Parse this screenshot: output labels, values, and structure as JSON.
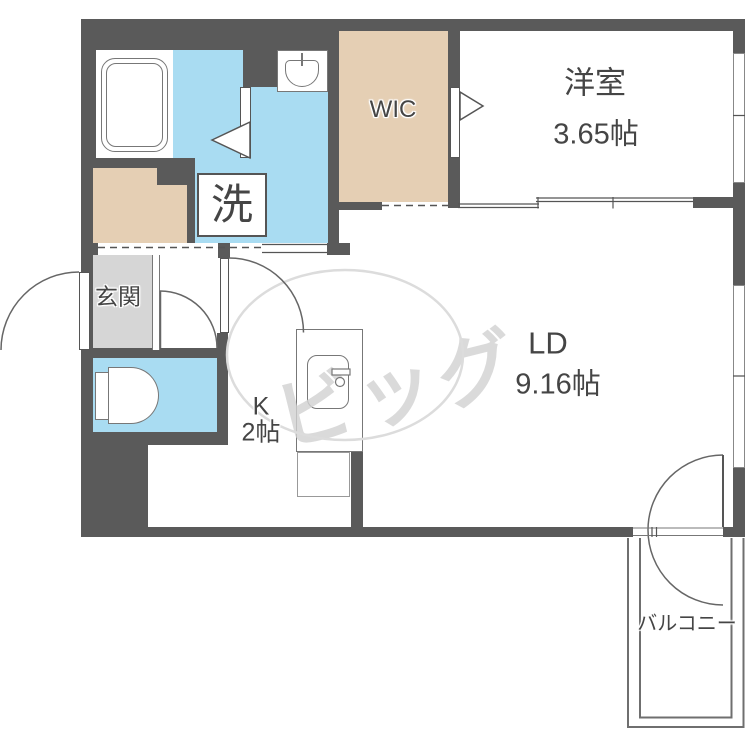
{
  "plan": {
    "type": "apartment-floorplan",
    "rooms": {
      "western": {
        "label": "洋室",
        "area": "3.65帖"
      },
      "wic": {
        "label": "WIC"
      },
      "living": {
        "label": "LD",
        "area": "9.16帖"
      },
      "kitchen": {
        "label": "K",
        "area": "2帖"
      },
      "entrance": {
        "label": "玄関"
      },
      "laundry": {
        "label": "洗"
      },
      "balcony": {
        "label": "バルコニー"
      }
    },
    "watermark": {
      "text": "ビッグ"
    },
    "fixtures": {
      "bathtub": "bathtub-icon",
      "washbasin": "washbasin-icon",
      "toilet": "toilet-icon",
      "kitchen_sink": "kitchen-sink-icon"
    },
    "colors": {
      "wall": "#5a5a5a",
      "water_area": "#a9dcf2",
      "closet": "#e5cfb4",
      "entrance_floor": "#d6d6d6",
      "fixture_line": "#777777",
      "label_text": "#454545",
      "watermark": "#d2d2d2"
    }
  }
}
